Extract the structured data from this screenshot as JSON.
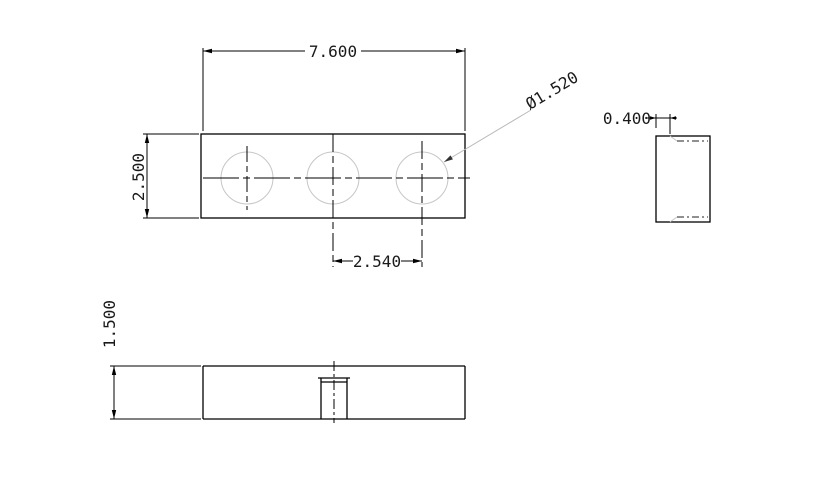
{
  "drawing": {
    "title": "three-view part drawing",
    "colors": {
      "background": "#ffffff",
      "outline": "#000000",
      "thin_geometry": "#c6c6c6",
      "text": "#1a1a1a"
    },
    "dimensions": {
      "top_width": "7.600",
      "plate_height": "2.500",
      "hole_spacing": "2.540",
      "hole_diameter": "Ø1.520",
      "side_offset": "0.400",
      "front_thickness": "1.500"
    }
  }
}
